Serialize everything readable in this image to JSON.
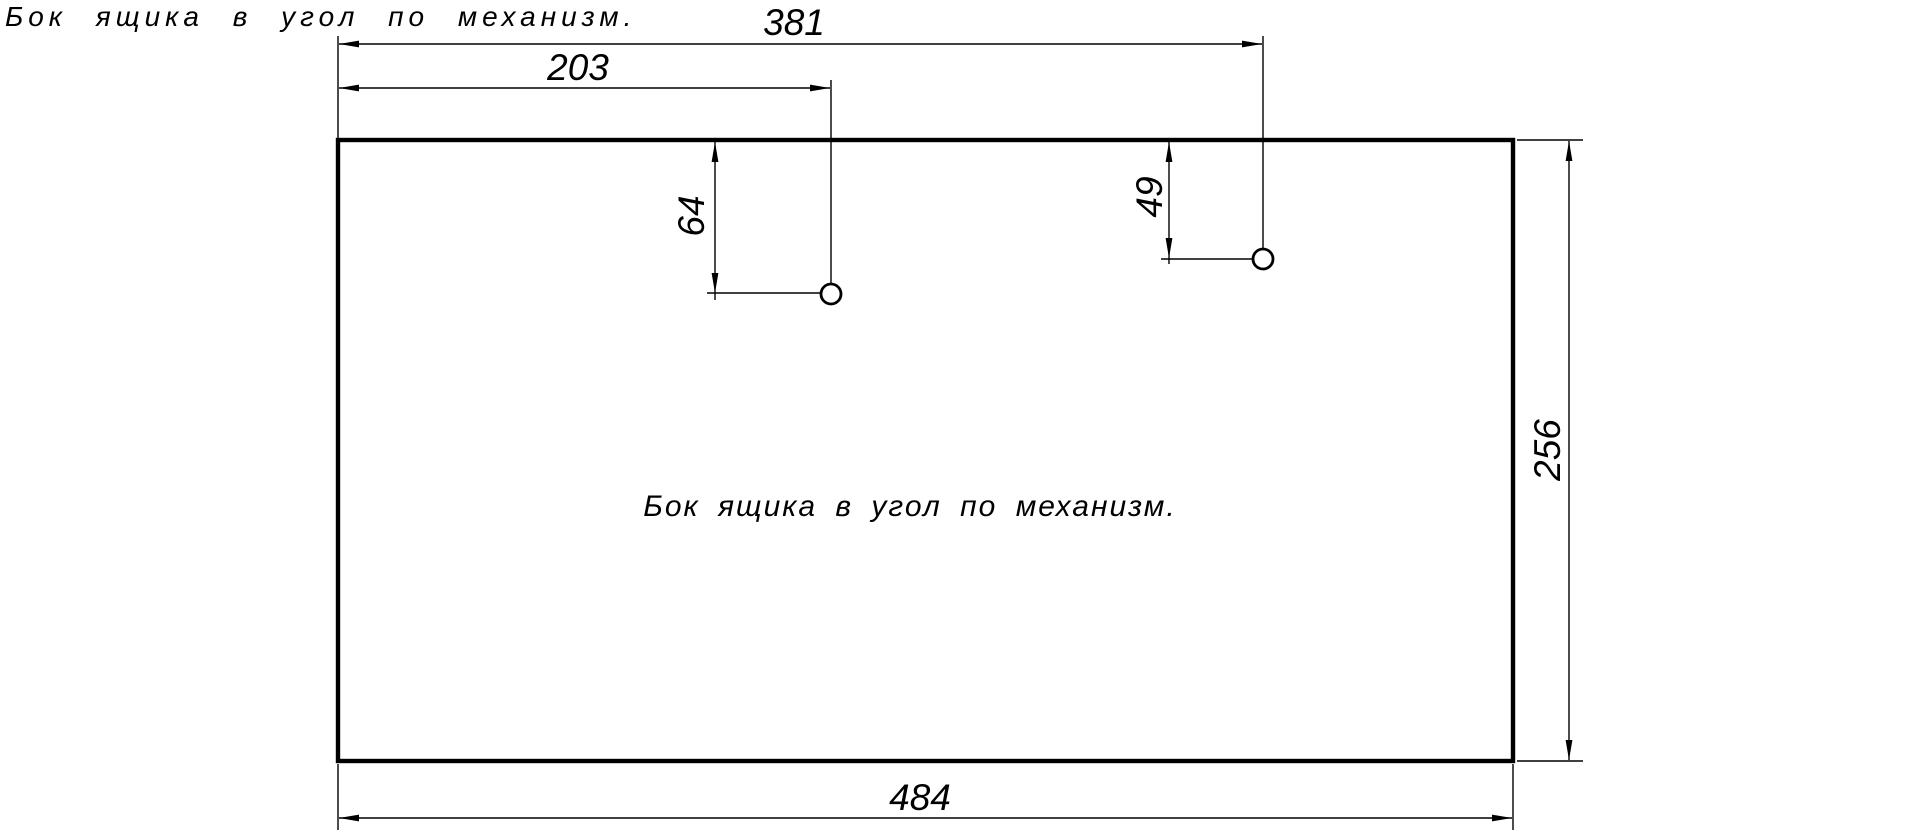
{
  "drawing": {
    "title": "Бок ящика в угол по механизм.",
    "part_label": "Бок ящика в угол по механизм.",
    "dimensions": {
      "hole2_from_left": "381",
      "hole1_from_left": "203",
      "hole1_from_top": "64",
      "hole2_from_top": "49",
      "panel_height": "256",
      "panel_width": "484"
    },
    "colors": {
      "ink": "#000000",
      "background": "#ffffff"
    }
  }
}
